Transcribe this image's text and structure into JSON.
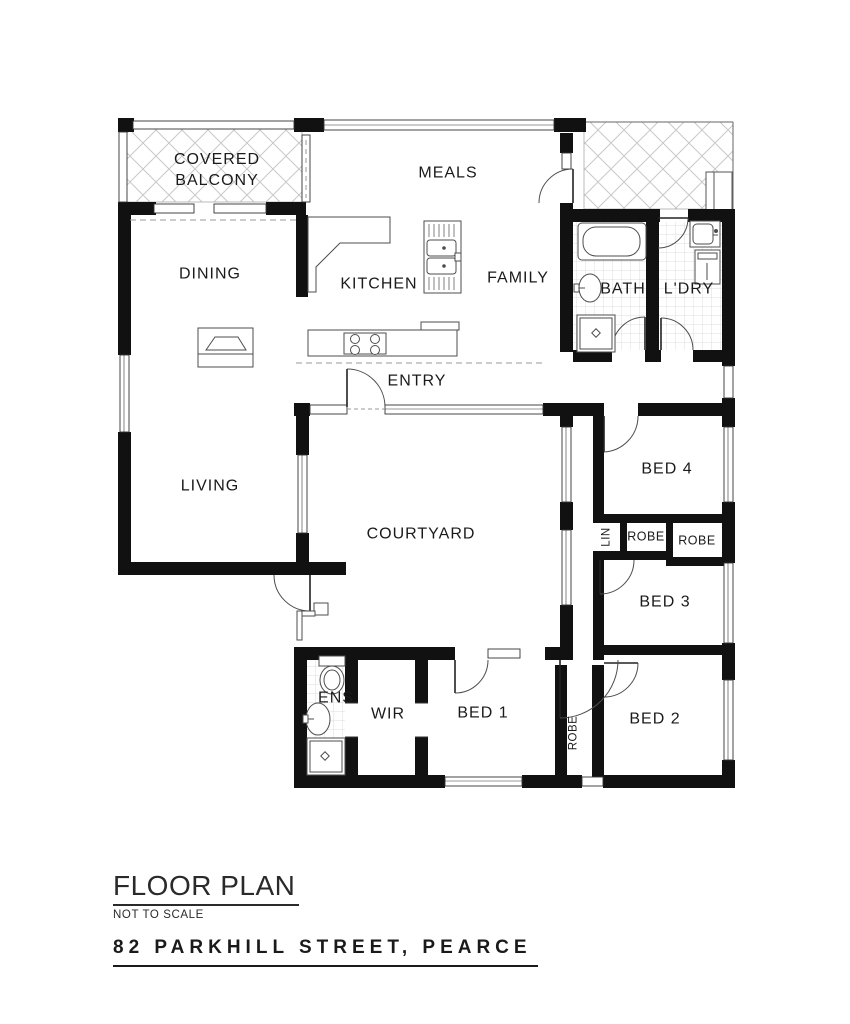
{
  "title_block": {
    "title": "FLOOR PLAN",
    "scale_note": "NOT TO SCALE",
    "address": "82 PARKHILL STREET, PEARCE"
  },
  "rooms": {
    "covered_balcony_line1": "COVERED",
    "covered_balcony_line2": "BALCONY",
    "meals": "MEALS",
    "dining": "DINING",
    "kitchen": "KITCHEN",
    "family": "FAMILY",
    "bath": "BATH",
    "laundry": "L'DRY",
    "entry": "ENTRY",
    "living": "LIVING",
    "courtyard": "COURTYARD",
    "bed4": "BED 4",
    "bed3": "BED 3",
    "bed2": "BED 2",
    "bed1": "BED 1",
    "wir": "WIR",
    "ens": "ENS",
    "linen": "LIN",
    "robe_bed4": "ROBE",
    "robe_bed3": "ROBE",
    "robe_bed1": "ROBE"
  },
  "colors": {
    "wall": "#111111",
    "thin_line": "#4d4d4d",
    "hatch": "#c9c9c9",
    "tile": "#dcdcdc",
    "dash": "#9a9a9a",
    "text": "#1a1a1a"
  }
}
